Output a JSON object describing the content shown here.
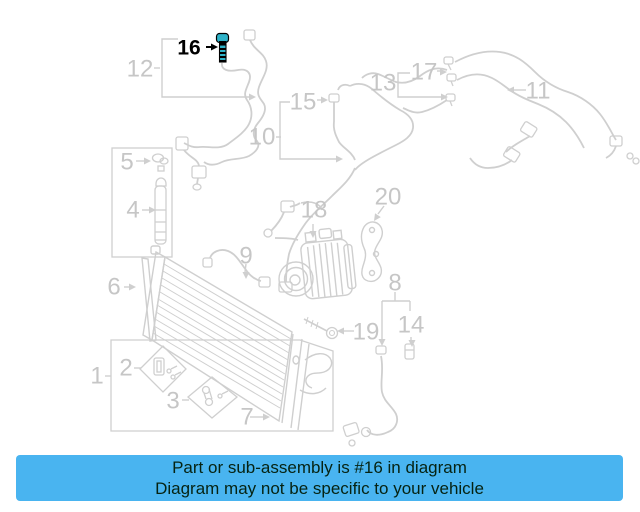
{
  "banner": {
    "line1": "Part or sub-assembly is #16 in diagram",
    "line2": "Diagram may not be specific to your vehicle",
    "bg_color": "#49b4f0",
    "text_color": "#062312"
  },
  "diagram": {
    "background": "#ffffff",
    "line_color": "#cfcfcf",
    "label_color": "#c6c6c6",
    "highlight_color": "#000000",
    "highlight_part_fill": "#2fb3c9",
    "highlighted_part": "16",
    "labels": [
      {
        "text": "1",
        "x": 97,
        "y": 376,
        "highlighted": false
      },
      {
        "text": "2",
        "x": 126,
        "y": 368,
        "highlighted": false
      },
      {
        "text": "3",
        "x": 173,
        "y": 401,
        "highlighted": false
      },
      {
        "text": "4",
        "x": 133,
        "y": 210,
        "highlighted": false
      },
      {
        "text": "5",
        "x": 127,
        "y": 162,
        "highlighted": false
      },
      {
        "text": "6",
        "x": 114,
        "y": 287,
        "highlighted": false
      },
      {
        "text": "7",
        "x": 247,
        "y": 417,
        "highlighted": false
      },
      {
        "text": "8",
        "x": 395,
        "y": 283,
        "highlighted": false
      },
      {
        "text": "9",
        "x": 246,
        "y": 256,
        "highlighted": false
      },
      {
        "text": "10",
        "x": 262,
        "y": 137,
        "highlighted": false
      },
      {
        "text": "11",
        "x": 538,
        "y": 91,
        "highlighted": false
      },
      {
        "text": "12",
        "x": 140,
        "y": 69,
        "highlighted": false
      },
      {
        "text": "13",
        "x": 383,
        "y": 83,
        "highlighted": false
      },
      {
        "text": "14",
        "x": 411,
        "y": 325,
        "highlighted": false
      },
      {
        "text": "15",
        "x": 303,
        "y": 102,
        "highlighted": false
      },
      {
        "text": "16",
        "x": 189,
        "y": 48,
        "highlighted": true
      },
      {
        "text": "17",
        "x": 424,
        "y": 72,
        "highlighted": false
      },
      {
        "text": "18",
        "x": 314,
        "y": 210,
        "highlighted": false
      },
      {
        "text": "19",
        "x": 366,
        "y": 332,
        "highlighted": false
      },
      {
        "text": "20",
        "x": 388,
        "y": 197,
        "highlighted": false
      }
    ]
  }
}
